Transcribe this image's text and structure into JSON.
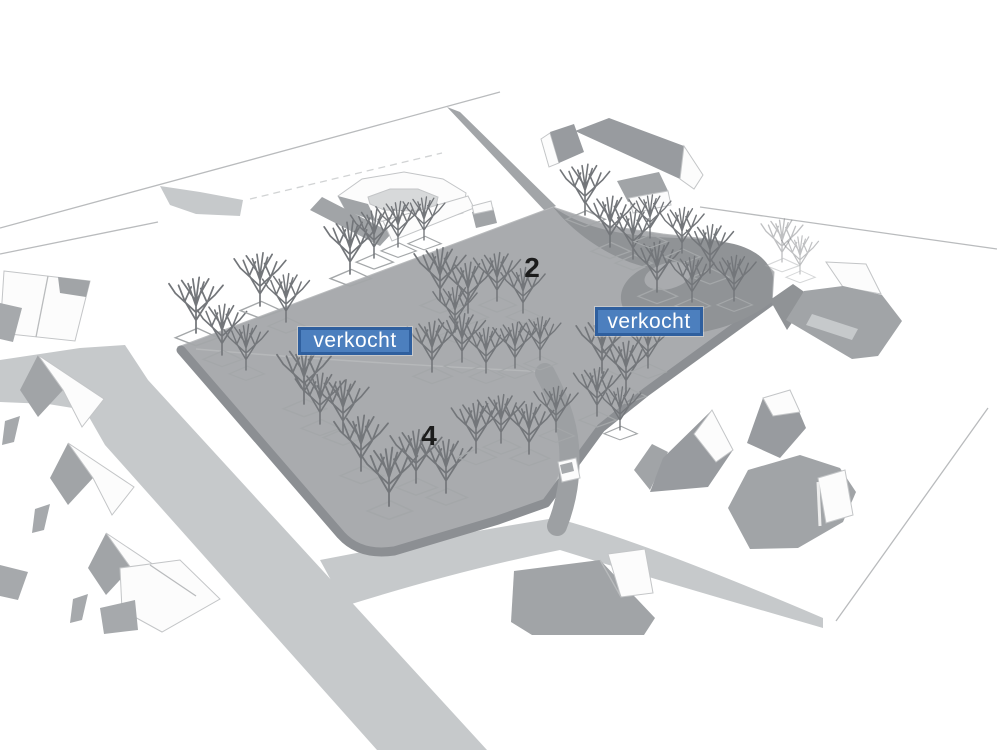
{
  "scene": {
    "kind": "3d-sketch-site-plan",
    "colors": {
      "background": "#ffffff",
      "plot_fill": "#a9abae",
      "plot_edge": "#8c8f93",
      "road_fill": "#c6c9cb",
      "road_dark": "#909396",
      "feeder_band": "#a2a5a8",
      "driveway": "#9da0a3",
      "roof_gray": "#a1a4a7",
      "roof_dark": "#989b9f",
      "white_face": "#fcfcfc",
      "face_stroke": "#c3c5c7",
      "outline_stroke": "#b9bbbd",
      "shadow_gray": "#a6a9ac",
      "tree_color": "#73767a",
      "tree_ground": "#a4a7a9",
      "badge_fill": "#4c7fbe",
      "badge_border": "#2f5f9e",
      "badge_text": "#ffffff",
      "number_color": "#1c1c1c"
    },
    "badges": [
      {
        "text": "verkocht",
        "x": 595,
        "y": 307,
        "width": 108,
        "height": 29
      },
      {
        "text": "verkocht",
        "x": 298,
        "y": 327,
        "width": 114,
        "height": 28
      }
    ],
    "plot_numbers": [
      {
        "text": "2",
        "x": 532,
        "y": 268
      },
      {
        "text": "4",
        "x": 429,
        "y": 436
      }
    ]
  }
}
